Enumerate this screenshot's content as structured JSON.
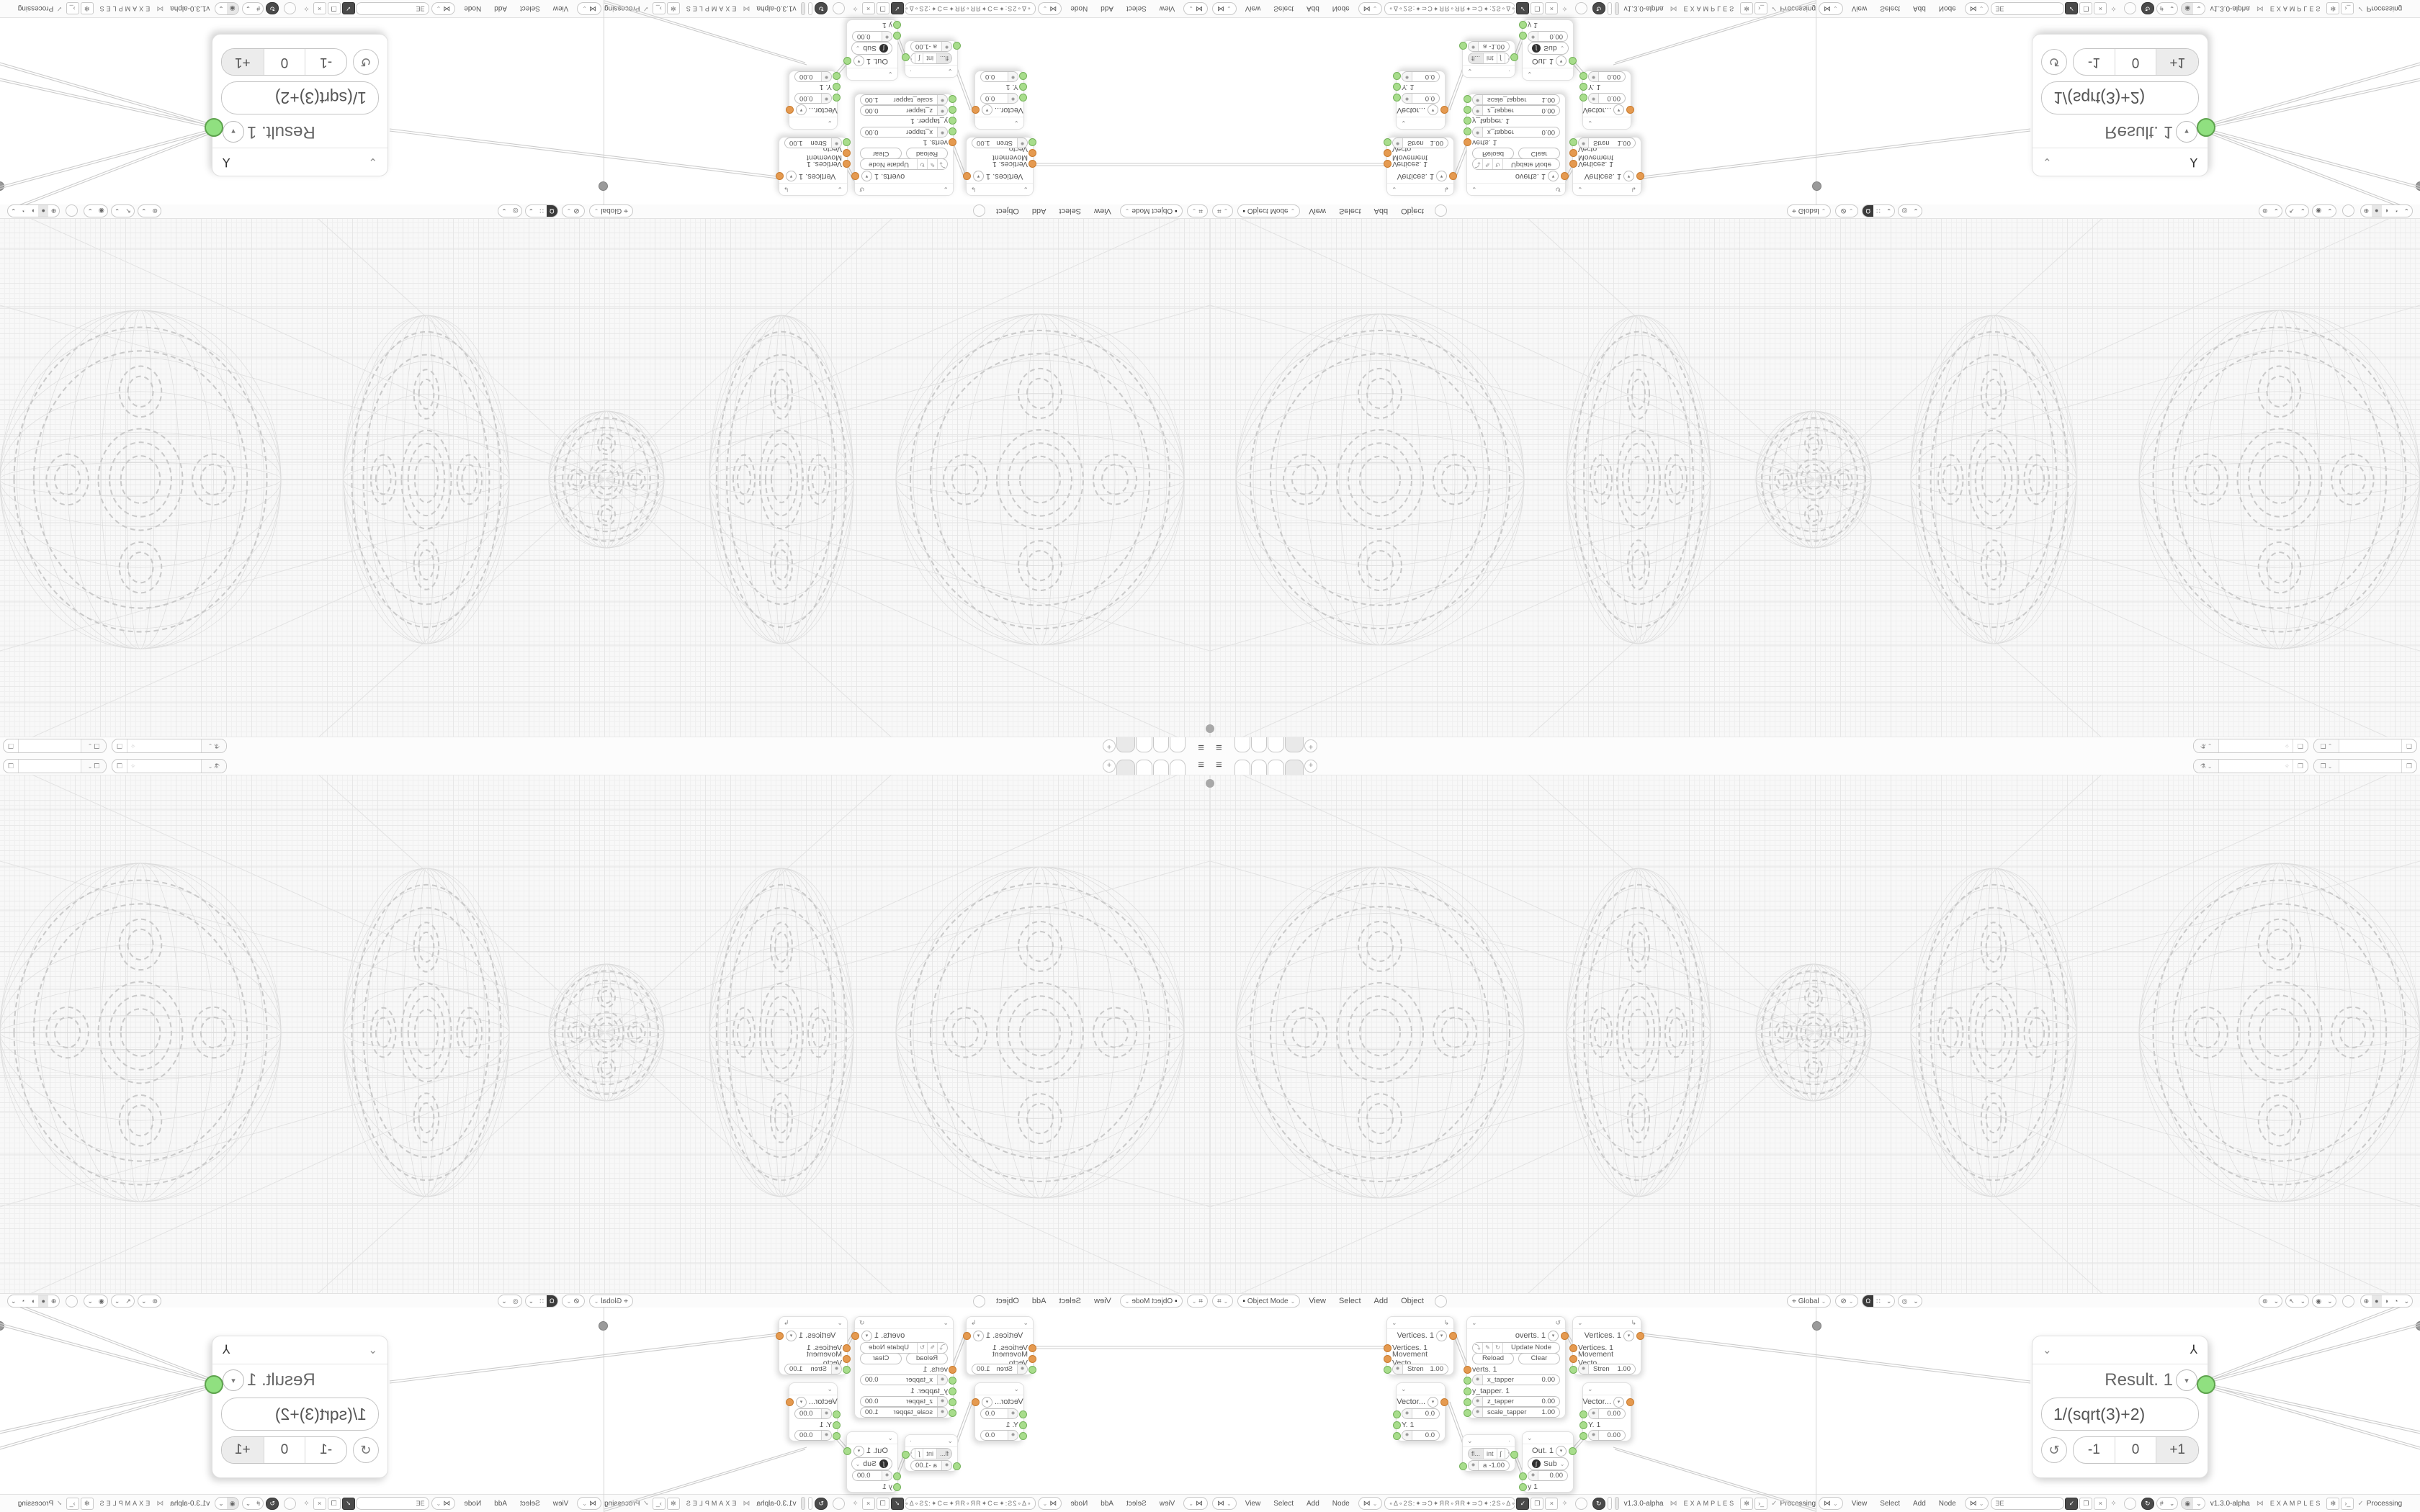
{
  "app": {
    "version": "v1.3.0-alpha",
    "examples_label": "EXAMPLES",
    "status": "Processing",
    "filter_left_value": "∘Δ∘2S:✦⊃Ɔ✦ЯR∘ЯR✦⊃Ɔ✦:2S∘Δ∘",
    "filter_right_value": "ƎE"
  },
  "icons": {
    "hamburger": "≡",
    "plus": "+",
    "chevron_down": "⌄",
    "dropdown": "▾",
    "loop": "↺",
    "axes": "↳",
    "close": "×",
    "check": "✓",
    "pin": "✧",
    "dna": "⋈",
    "magnet": "Ω",
    "snap_grid": "∷",
    "proportional": "◎",
    "pivot": "⊘",
    "orientation": "⌖",
    "editor_3d": "⌗",
    "mode_square": "▪",
    "overlay": "◉",
    "gizmo": "↖",
    "visibility": "⊚",
    "wireframe": "⊕",
    "solid": "●",
    "material": "◑",
    "rendered": "◔",
    "refresh": "↻",
    "hash": "#",
    "shield_check": "✓",
    "copy": "❐",
    "terminal": "›_",
    "flask": "✻",
    "scene": "⚗",
    "layers": "❐",
    "func": "∫",
    "tool_y": "⅄",
    "reload_arrow": "⤵",
    "pen": "✎",
    "socket_toggle": "✹"
  },
  "topbar": {
    "tab_count": "4",
    "add_label": "+"
  },
  "viewport_header": {
    "mode": "Object Mode",
    "menus": [
      "View",
      "Select",
      "Add",
      "Object"
    ],
    "orientation": "Global"
  },
  "node_header": {
    "menus": [
      "View",
      "Select",
      "Add",
      "Node"
    ]
  },
  "nodes": {
    "vertices1": {
      "title": "Vertices. 1",
      "in1": "Vertices. 1",
      "in2": "Movement Vecto...",
      "field": "Stren",
      "value": "1.00"
    },
    "vertices2": {
      "title": "Vertices. 1",
      "in1": "Vertices. 1",
      "in2": "Movement Vecto...",
      "field": "Stren",
      "value": "1.00"
    },
    "vector1": {
      "title": "Vector...",
      "v1": "0.0",
      "y": "Y. 1",
      "v2": "0.0"
    },
    "vector2": {
      "title": "Vector...",
      "v1": "0.00",
      "y": "Y. 1",
      "v2": "0.00"
    },
    "overts": {
      "title": "overts. 1",
      "update": "Update Node",
      "reload": "Reload",
      "clear": "Clear",
      "in1": "verts. 1",
      "f1": "x_tapper",
      "f1v": "0.00",
      "f2": "y_tapper. 1",
      "f3": "z_tapper",
      "f3v": "0.00",
      "f4": "scale_tapper",
      "f4v": "1.00"
    },
    "literal": {
      "seg1": "fl...",
      "seg2": "int",
      "field": "a",
      "value": "-1.00"
    },
    "out": {
      "title": "Out. 1",
      "op": "Sub",
      "value": "0.00",
      "y": "y 1"
    },
    "result": {
      "title": "Result. 1",
      "expression": "1/(sqrt(3)+2)",
      "dec": "-1",
      "zero": "0",
      "inc": "+1"
    }
  }
}
